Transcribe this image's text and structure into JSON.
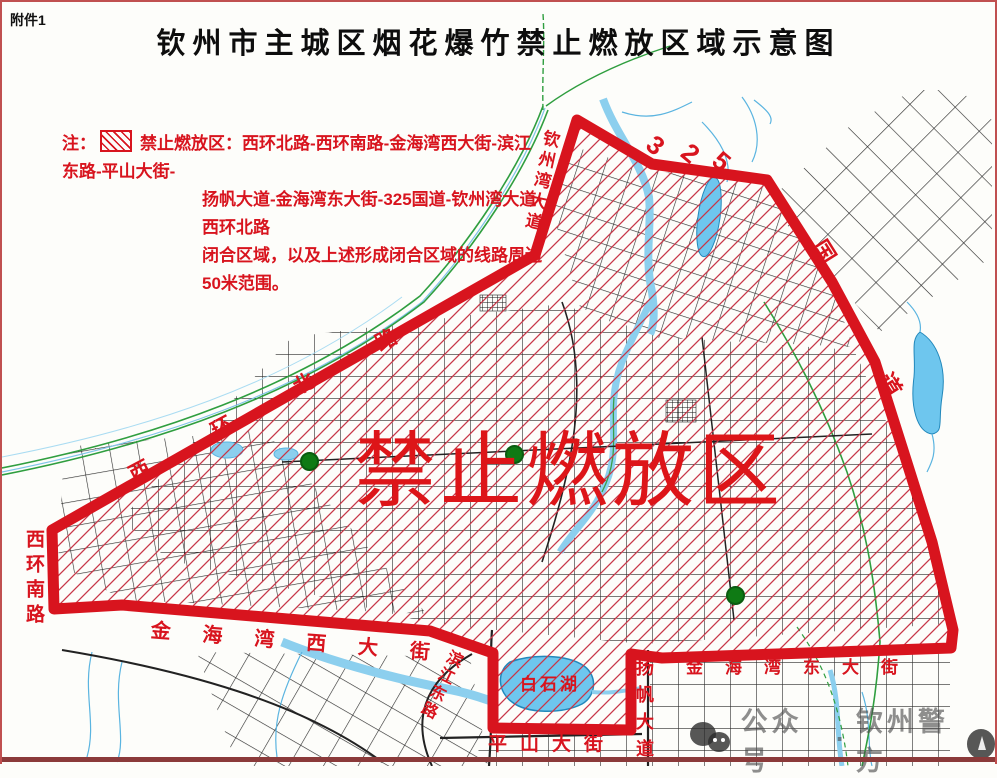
{
  "attachment_label": "附件1",
  "title": "钦州市主城区烟花爆竹禁止燃放区域示意图",
  "legend": {
    "prefix": "注：",
    "swatch_icon": "red-diagonal-hatch-swatch",
    "line1": "禁止燃放区：西环北路-西环南路-金海湾西大街-滨江东路-平山大街-",
    "line2": "扬帆大道-金海湾东大街-325国道-钦州湾大道-西环北路",
    "line3": "闭合区域，以及上述形成闭合区域的线路周边50米范围。"
  },
  "map": {
    "zone_label": "禁止燃放区",
    "route_number": "325",
    "labels": {
      "xihuan_nan_lu": "西环南路",
      "xihuan_bei_lu": "西环北路",
      "qinzhouwan_dadao": "钦州湾大道",
      "digit3": "3",
      "digit2": "2",
      "digit5": "5",
      "guo": "国",
      "dao": "道",
      "jinhaiwan_xi_dajie": "金海湾西大街",
      "binjiang_donglu": "滨江东路",
      "baishihu": "白石湖",
      "pingshan_dajie": "平山大街",
      "yangfan_dadao": "扬帆大道",
      "jinhaiwan_dong_dajie": "金海湾东大街"
    },
    "poi_marker_icon": "green-route-shield-icon"
  },
  "watermark": {
    "chat_icon": "chat-bubbles-icon",
    "left": "公众号",
    "separator": "·",
    "right": "钦州警方",
    "badge_icon": "police-badge-icon"
  },
  "colors": {
    "boundary_red": "#d8141e",
    "hatch_red": "#c73748",
    "label_red": "#d8141e",
    "water_blue": "#8ccfee",
    "lake_blue": "#6ec6ee",
    "railway_green": "#2f9e3f",
    "poi_green": "#0f7a14",
    "street_dark": "#2b2b2b",
    "frame_red": "#c05050"
  }
}
